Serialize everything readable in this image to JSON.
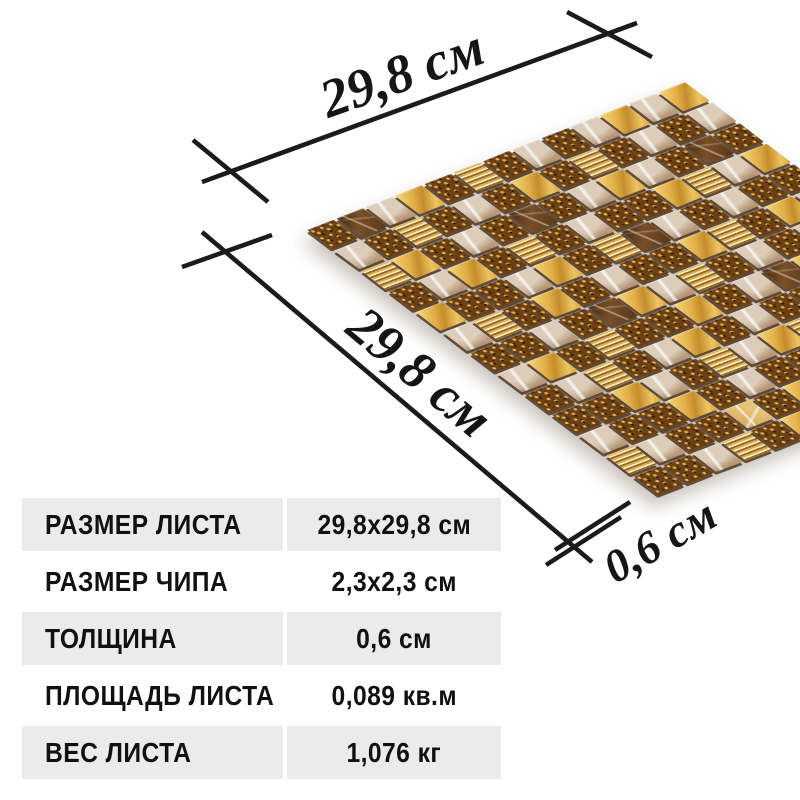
{
  "dimensions": {
    "width_label": "29,8 см",
    "height_label": "29,8 см",
    "thickness_label": "0,6 см"
  },
  "spec_table": {
    "rows": [
      {
        "label": "РАЗМЕР ЛИСТА",
        "value": "29,8x29,8 см"
      },
      {
        "label": "РАЗМЕР ЧИПА",
        "value": "2,3x2,3 см"
      },
      {
        "label": "ТОЛЩИНА",
        "value": "0,6 см"
      },
      {
        "label": "ПЛОЩАДЬ ЛИСТА",
        "value": "0,089 кв.м"
      },
      {
        "label": "ВЕС ЛИСТА",
        "value": "1,076 кг"
      }
    ],
    "row_bg_odd": "#ebebeb",
    "row_bg_even": "#ffffff"
  },
  "mosaic": {
    "grid": 13,
    "tile_types": {
      "G": "gold-foil-tile",
      "S": "speckled-bronze-tile",
      "M": "light-emperador-marble-tile",
      "D": "dark-emperador-marble-tile",
      "T": "striped-gold-tile",
      "C": "crackled-gold-tile"
    },
    "pattern": [
      "SDMGSTSMSMGMG",
      "MSTSMSGSTSMSM",
      "TGSMSDSMGMSDS",
      "SMGSTSMSSGTMG",
      "GSSMGSTDMSMSS",
      "MTSGSMSSGTSGM",
      "SSMSDGMTSMSMS",
      "MGSTSSGSMDGST",
      "SMTSMGSMSSMTS",
      "SSGMSTMGTMSMG",
      "MSSGSMSSMSGSM",
      "TMSSCSGMSGMDS",
      "SSMTSGSTMSSMS"
    ]
  },
  "colors": {
    "background": "#ffffff",
    "dimension_line": "#1b1b1b",
    "text": "#111111",
    "table_row_gray": "#ebebeb",
    "gold_accent": "#dca43c",
    "bronze_speckle": "#6b4015",
    "marble_light": "#c7ab8b"
  }
}
